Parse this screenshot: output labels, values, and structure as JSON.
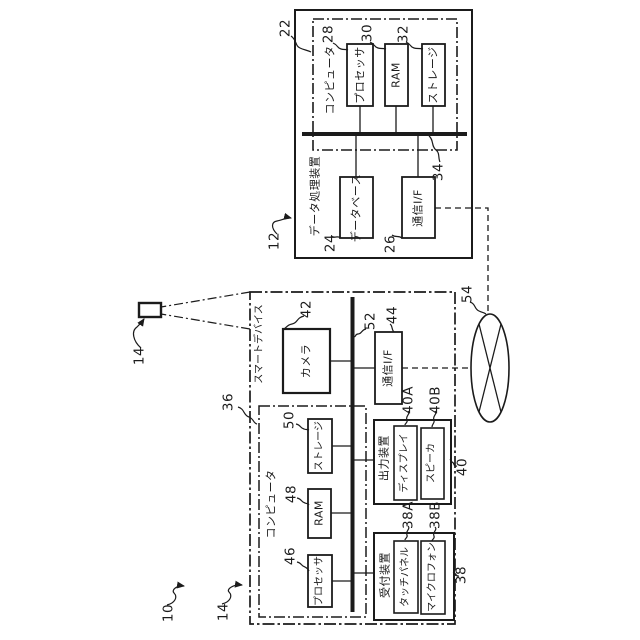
{
  "colors": {
    "line": "#1b1b1b",
    "background": "#ffffff"
  },
  "system_ref": "10",
  "subject_ref": "14",
  "network_ref": "54",
  "dpd": {
    "label": "データ処理装置",
    "ref": "12",
    "computer": {
      "label": "コンピュータ",
      "ref": "22"
    },
    "processor": {
      "label": "プロセッサ",
      "ref": "28"
    },
    "ram": {
      "label": "RAM",
      "ref": "30"
    },
    "storage": {
      "label": "ストレージ",
      "ref": "32"
    },
    "bus_ref": "34",
    "database": {
      "label": "データベース",
      "ref": "24"
    },
    "comm_if": {
      "label": "通信I/F",
      "ref": "26"
    }
  },
  "sd": {
    "label": "スマートデバイス",
    "ref": "14",
    "camera": {
      "label": "カメラ",
      "ref": "42"
    },
    "bus_ref": "52",
    "comm_if": {
      "label": "通信I/F",
      "ref": "44"
    },
    "computer": {
      "label": "コンピュータ",
      "ref": "36"
    },
    "storage": {
      "label": "ストレージ",
      "ref": "50"
    },
    "ram": {
      "label": "RAM",
      "ref": "48"
    },
    "processor": {
      "label": "プロセッサ",
      "ref": "46"
    },
    "output": {
      "label": "出力装置",
      "ref": "40",
      "display": {
        "label": "ディスプレイ",
        "ref": "40A"
      },
      "speaker": {
        "label": "スピーカ",
        "ref": "40B"
      }
    },
    "input": {
      "label": "受付装置",
      "ref": "38",
      "touch": {
        "label": "タッチパネル",
        "ref": "38A"
      },
      "mic": {
        "label": "マイクロフォン",
        "ref": "38B"
      }
    }
  }
}
